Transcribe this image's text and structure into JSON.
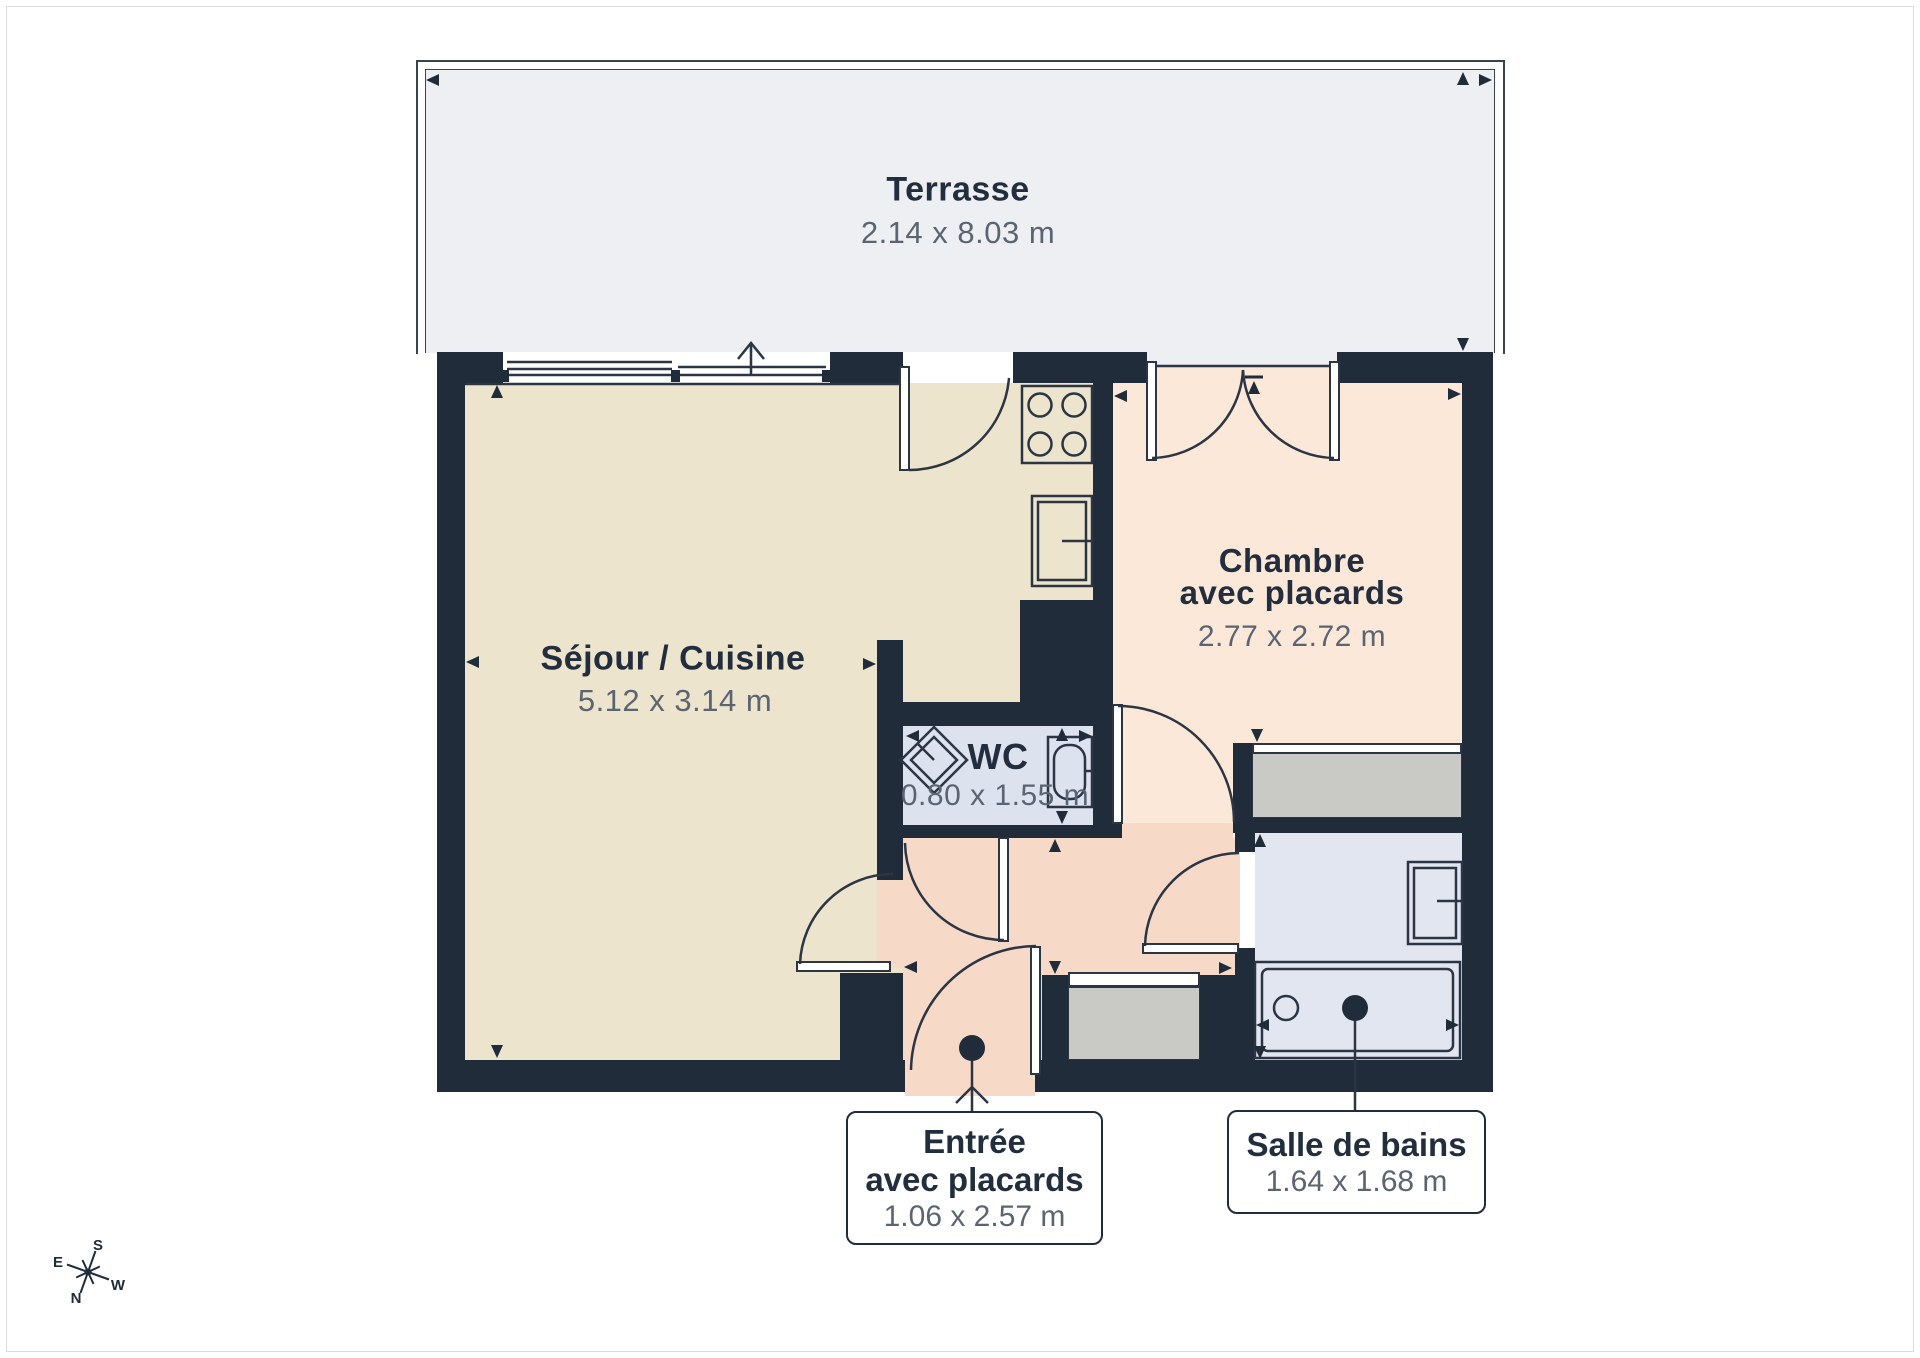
{
  "rooms": {
    "terrasse": {
      "name": "Terrasse",
      "dims": "2.14 x 8.03 m"
    },
    "sejour": {
      "name": "Séjour / Cuisine",
      "dims": "5.12 x 3.14 m"
    },
    "chambre": {
      "name": "Chambre",
      "name2": "avec placards",
      "dims": "2.77 x 2.72 m"
    },
    "wc": {
      "name": "WC",
      "dims": "0.80 x 1.55 m"
    },
    "entree": {
      "name": "Entrée",
      "name2": "avec placards",
      "dims": "1.06 x 2.57 m"
    },
    "salle_de_bains": {
      "name": "Salle de bains",
      "dims": "1.64 x 1.68 m"
    }
  },
  "compass": {
    "n": "N",
    "s": "S",
    "e": "E",
    "w": "W"
  },
  "colors": {
    "wall": "#212c3a",
    "line": "#2b3544",
    "title": "#222e3e",
    "dims": "#5b6472",
    "cream": "#ece4cc",
    "peach": "#fbe8d8",
    "salmon": "#f6d9c7",
    "wcfloor": "#dde2ef",
    "bathfloor": "#e2e6f1",
    "terrace": "#edeff2",
    "closet": "#c9c9c5",
    "pageborder": "#d9dbde"
  }
}
